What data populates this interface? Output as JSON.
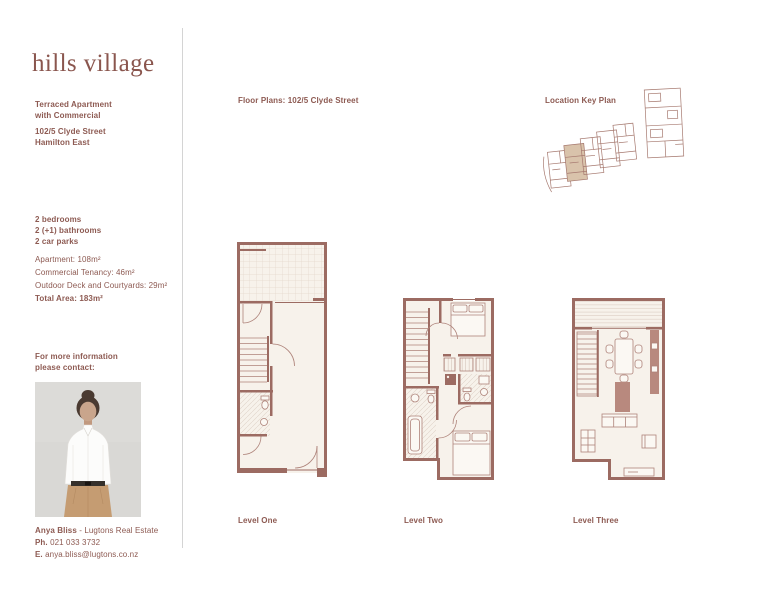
{
  "brand": {
    "logo_text": "hills village"
  },
  "colors": {
    "accent_text": "#8d5a52",
    "wall": "#9c6b62",
    "floor": "#f7f2eb",
    "unit_highlight": "#d9c3ab",
    "divider": "#d4d4d4"
  },
  "sidebar": {
    "property_type": "Terraced Apartment\nwith Commercial",
    "address": "102/5 Clyde Street\nHamilton East",
    "specs": [
      "2 bedrooms",
      "2 (+1) bathrooms",
      "2 car parks"
    ],
    "areas": [
      "Apartment: 108m²",
      "Commercial Tenancy: 46m²",
      "Outdoor Deck and Courtyards: 29m²"
    ],
    "total_area": "Total Area: 183m²",
    "contact_prompt": "For more information\nplease contact:",
    "agent": {
      "name": "Anya Bliss",
      "company": "- Lugtons Real Estate",
      "phone_label": "Ph.",
      "phone": "021 033 3732",
      "email_label": "E.",
      "email": "anya.bliss@lugtons.co.nz"
    }
  },
  "main": {
    "floor_plans_title": "Floor Plans: 102/5 Clyde Street",
    "location_key_title": "Location Key Plan",
    "levels": [
      {
        "label": "Level One"
      },
      {
        "label": "Level Two"
      },
      {
        "label": "Level Three"
      }
    ]
  }
}
